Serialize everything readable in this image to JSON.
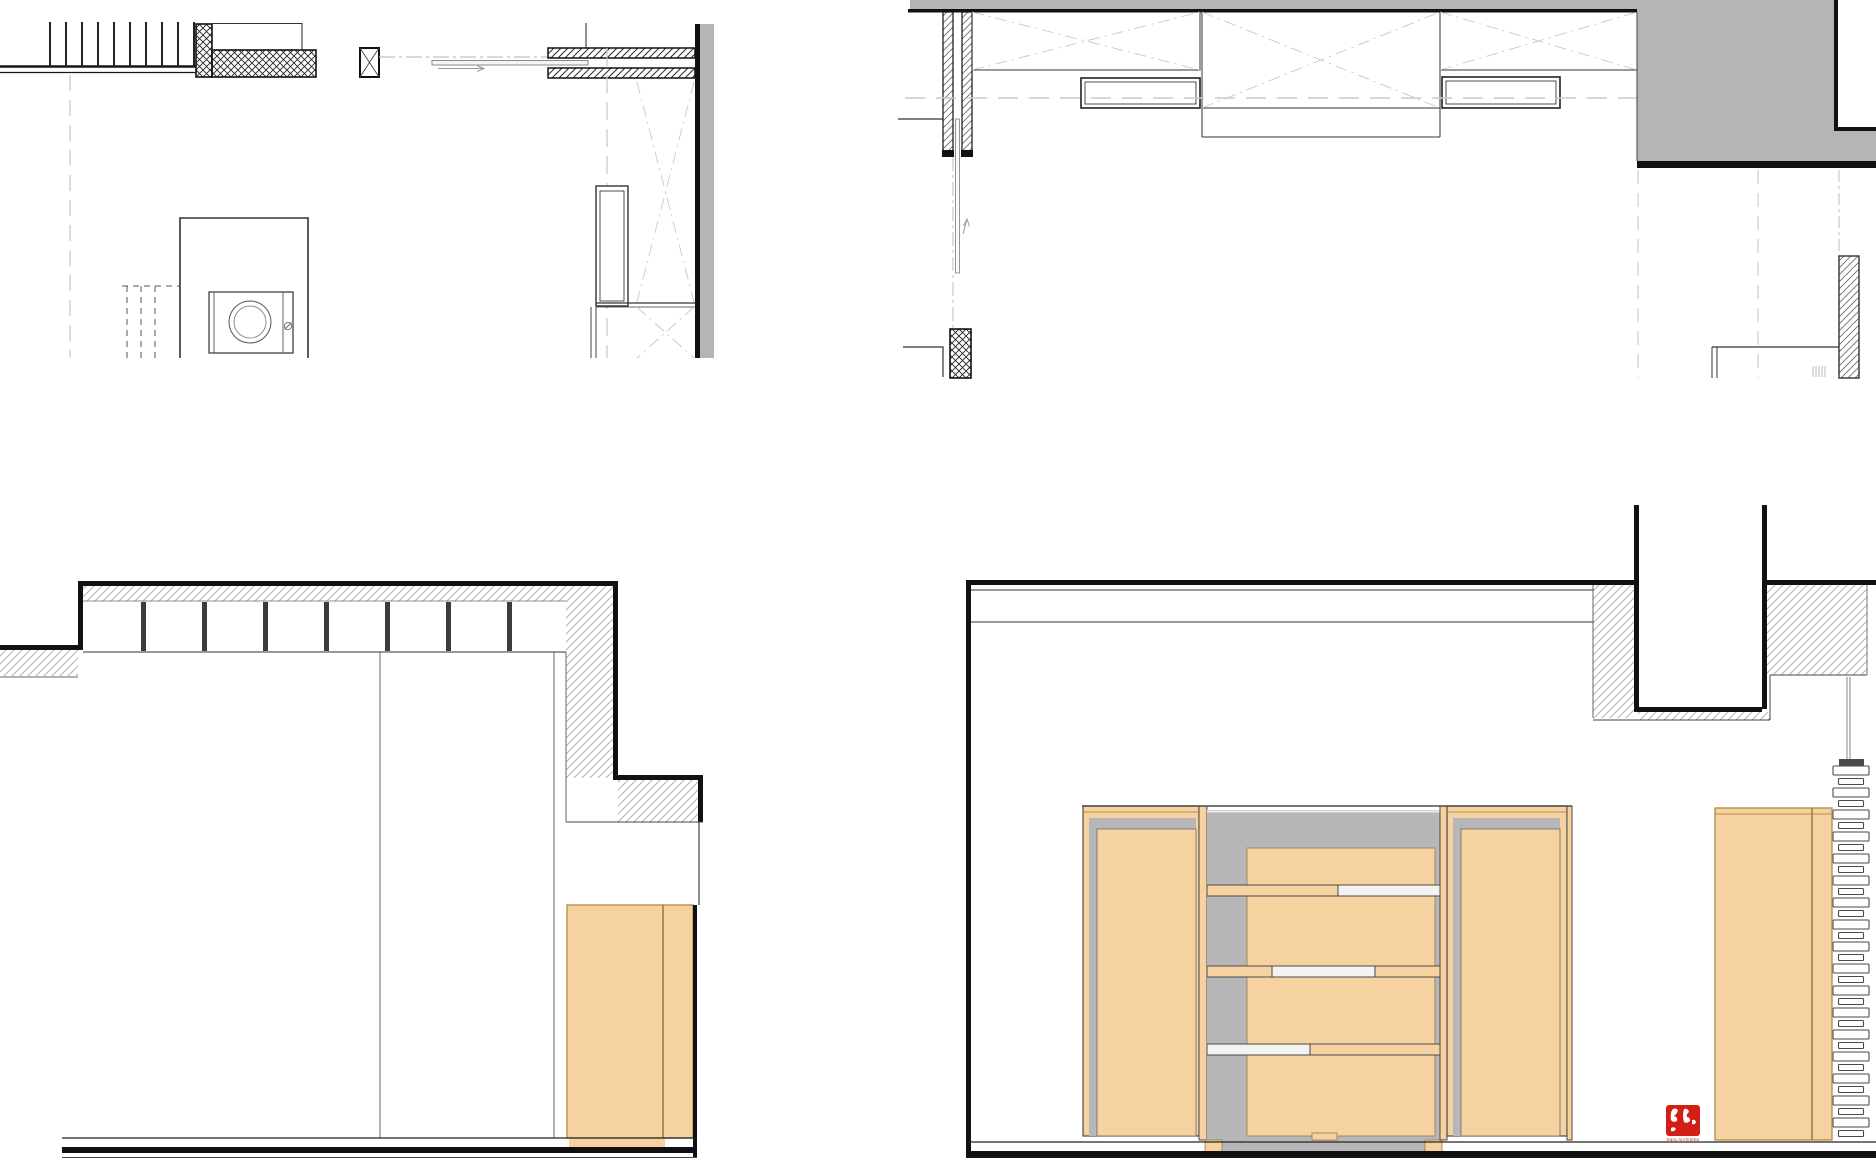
{
  "sheet": {
    "background": "#ffffff",
    "description_counts": {
      "plan_panels": 2,
      "elevation_panels": 2
    }
  },
  "colors": {
    "ink": "#161616",
    "wood": "#f5d2a0",
    "wood_edge": "#b8904f",
    "wood_dark": "#9c7a40",
    "poche": "#b5b5b7",
    "panel_gray": "#b7b7b9",
    "glass": "#f3f3f1",
    "light_line": "#c8c8cc",
    "mid_line": "#8a8a8a",
    "seal_red": "#d21e14"
  },
  "logo": {
    "caption": "Sara Architetto"
  },
  "generated": {
    "stair_ticks": {
      "count": 10,
      "x0": 50,
      "dx": 16,
      "y1": 22,
      "y2": 66,
      "stroke": "#222222",
      "w": 2
    },
    "joist_ticks": {
      "count": 7,
      "x0": 141,
      "dx": 61,
      "y": 602,
      "h": 49,
      "w": 5,
      "fill": "#3c3c3c"
    },
    "stack_rings": {
      "count": 34,
      "x_wide": 1833,
      "w_wide": 36,
      "h_wide": 9,
      "x_narrow": 1838.5,
      "w_narrow": 25,
      "h_narrow": 6,
      "gap": 3.5,
      "y0": 766,
      "stroke": "#4a4a4a",
      "fill": "#ffffff"
    },
    "vent_lines": {
      "count": 5,
      "x0": 1813,
      "dx": 3,
      "y1": 366,
      "y2": 377,
      "stroke": "#b9b9b9"
    }
  }
}
